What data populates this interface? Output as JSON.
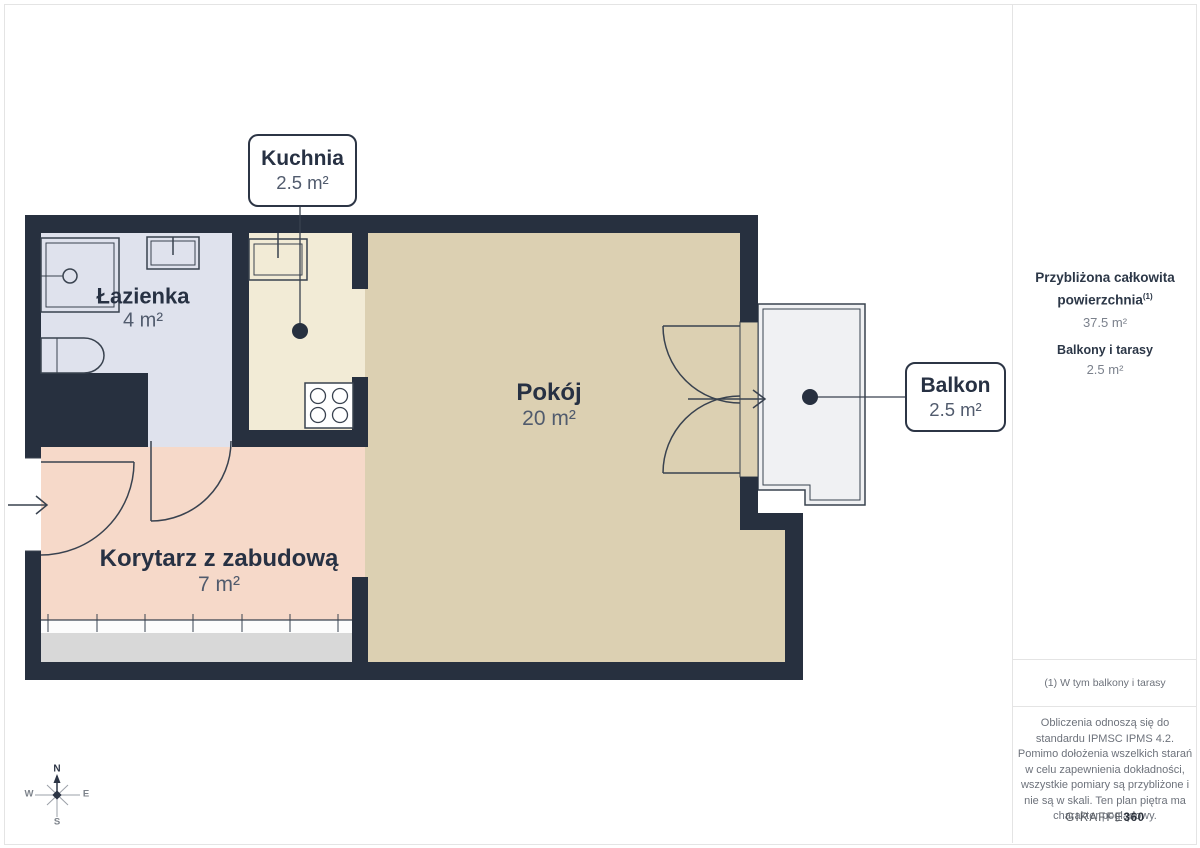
{
  "colors": {
    "wall": "#27303f",
    "bathroom": "#dfe2ed",
    "kitchen": "#f2ebd6",
    "room": "#dcd0b2",
    "corridor": "#f6d9c9",
    "balcony": "#f0f1f3",
    "wardrobe": "#d8d8d8"
  },
  "rooms": {
    "lazienka": {
      "name": "Łazienka",
      "area": "4 m²"
    },
    "kuchnia": {
      "name": "Kuchnia",
      "area": "2.5 m²"
    },
    "pokoj": {
      "name": "Pokój",
      "area": "20 m²"
    },
    "korytarz": {
      "name": "Korytarz z zabudową",
      "area": "7 m²"
    },
    "balkon": {
      "name": "Balkon",
      "area": "2.5 m²"
    }
  },
  "sidebar": {
    "total_label_line1": "Przybliżona całkowita",
    "total_label_line2": "powierzchnia",
    "total_superscript": "(1)",
    "total_value": "37.5 m²",
    "balcony_label": "Balkony i tarasy",
    "balcony_value": "2.5 m²",
    "footnote": "(1) W tym balkony i tarasy",
    "disclaimer": "Obliczenia odnoszą się do standardu IPMSC IPMS 4.2. Pomimo dołożenia wszelkich starań w celu zapewnienia dokładności, wszystkie pomiary są przybliżone i nie są w skali. Ten plan piętra ma charakter poglądowy.",
    "logo_text": "GIRAFFE",
    "logo_suffix": "360"
  },
  "compass": {
    "n": "N",
    "s": "S",
    "e": "E",
    "w": "W"
  }
}
